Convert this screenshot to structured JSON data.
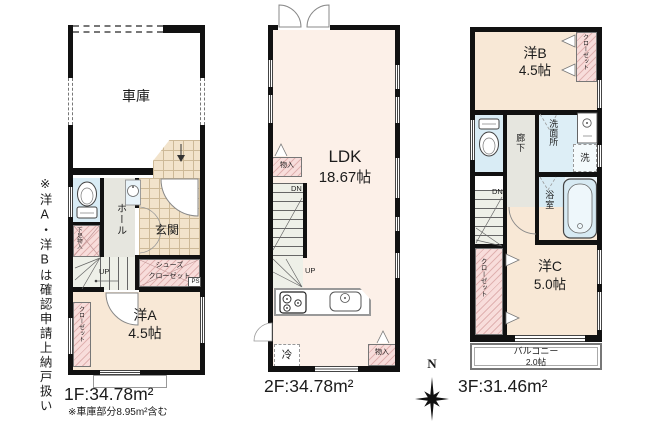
{
  "side_note": "※洋A・洋Bは確認申請上納戸扱い",
  "compass": {
    "north_label": "N"
  },
  "colors": {
    "wall": "#111111",
    "room": "#f8e8d6",
    "ldk": "#fcf0e8",
    "closet": "#f8dddb",
    "water": "#d9ecf5",
    "hall": "#e6e6df",
    "stairs": "#eef0e8",
    "tile": "#f2e3cb",
    "tileline": "#cdb997",
    "tub": "#d7eaf3"
  },
  "floor1": {
    "area_label": "1F:34.78m²",
    "area_note": "※車庫部分8.95m²含む",
    "garage": "車庫",
    "hall": "ホール",
    "entrance": "玄関",
    "shoes_closet_line1": "シューズ",
    "shoes_closet_line2": "クローゼット",
    "under_stairs": "下足物入",
    "closet": "クローゼット",
    "room_name": "洋A",
    "room_size": "4.5帖",
    "up": "UP",
    "ps": "PS"
  },
  "floor2": {
    "area_label": "2F:34.78m²",
    "ldk_name": "LDK",
    "ldk_size": "18.67帖",
    "storage_left": "物入",
    "storage_right": "物入",
    "fridge": "冷",
    "up": "UP",
    "dn": "DN"
  },
  "floor3": {
    "area_label": "3F:31.46m²",
    "room_b_name": "洋B",
    "room_b_size": "4.5帖",
    "closet_top": "クローゼット",
    "hallway": "廊下",
    "washroom": "洗面所",
    "washer": "洗",
    "bath": "浴室",
    "room_c_name": "洋C",
    "room_c_size": "5.0帖",
    "closet_bottom": "クローゼット",
    "balcony_name": "バルコニー",
    "balcony_size": "2.0帖",
    "dn": "DN"
  }
}
